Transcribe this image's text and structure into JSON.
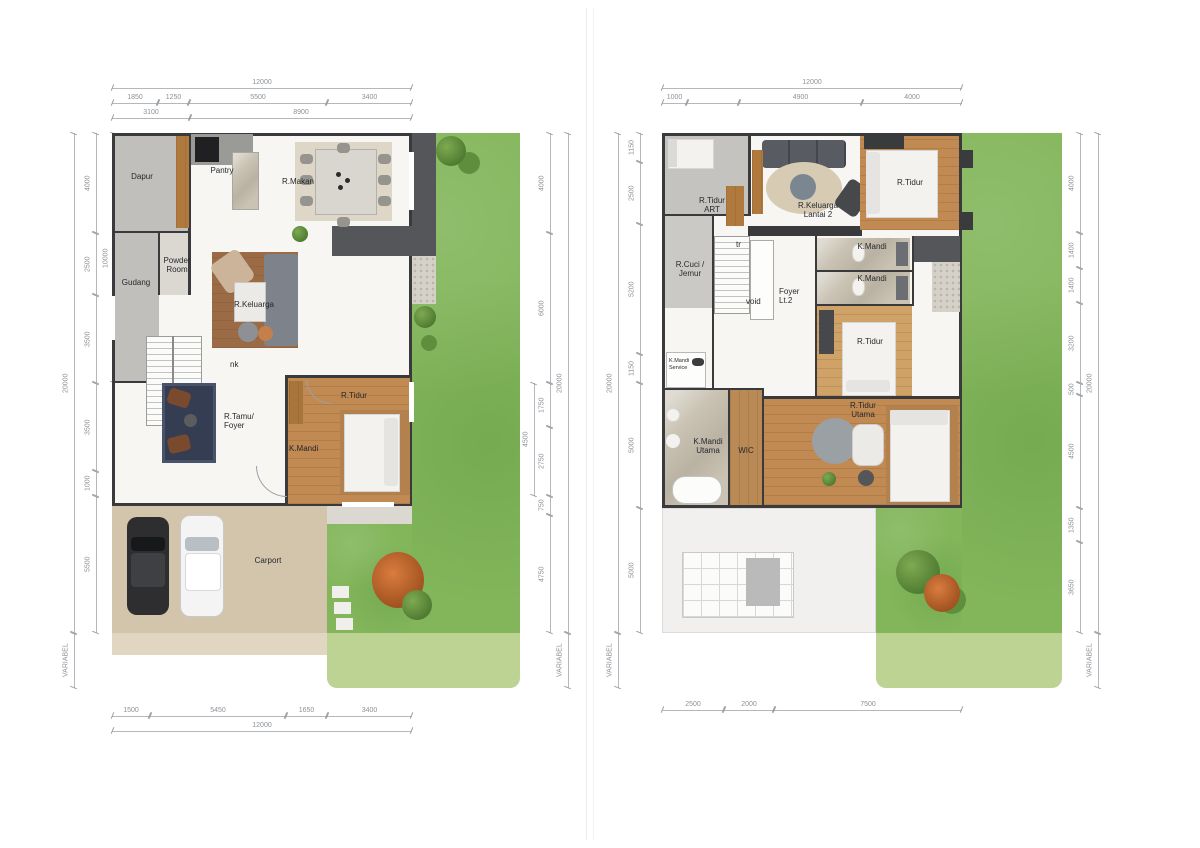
{
  "document": {
    "type": "architectural-floor-plan",
    "sheets": 2
  },
  "palette": {
    "wall": "#3a3a3c",
    "grass": "#83b65b",
    "grass_light": "#bdd394",
    "wood_floor": "#c18a52",
    "carport": "#d3c4ac",
    "dim_text": "#8d9296",
    "accent_shrub": "#c96a33"
  },
  "plans": [
    {
      "key": "lantai-1",
      "dims": {
        "top_total": "12000",
        "top_row1": [
          "1850",
          "1250",
          "5500",
          "3400"
        ],
        "top_row2": [
          "3100",
          "8900"
        ],
        "bottom_row": [
          "1500",
          "5450",
          "1650",
          "3400"
        ],
        "bottom_total": "12000",
        "left_segs": [
          "4000",
          "2500",
          "3500",
          "3500",
          "1000",
          "5500"
        ],
        "left_group": "10000",
        "left_total": "20000",
        "left_var": "VARIABEL",
        "right_segs": [
          "4000",
          "6000",
          "1750",
          "2750",
          "750",
          "4750"
        ],
        "right_group": "4500",
        "right_total": "20000",
        "right_var": "VARIABEL"
      },
      "rooms": {
        "dapur": "Dapur",
        "pantry": "Pantry",
        "r_makan": "R.Makan",
        "gudang": "Gudang",
        "powder_room": "Powder Room",
        "r_keluarga": "R.Keluarga",
        "stairs_note": "nk",
        "r_tamu": "R.Tamu/ Foyer",
        "k_mandi": "K.Mandi",
        "r_tidur": "R.Tidur",
        "carport": "Carport"
      }
    },
    {
      "key": "lantai-2",
      "dims": {
        "top_total": "12000",
        "top_row": [
          "1000",
          "",
          "4900",
          "4000"
        ],
        "bottom_row": [
          "2500",
          "2000",
          "7500"
        ],
        "left_segs": [
          "1150",
          "2500",
          "5200",
          "1150",
          "5000",
          "5000"
        ],
        "left_total": "20000",
        "left_var": "VARIABEL",
        "right_segs": [
          "4000",
          "1400",
          "1400",
          "3200",
          "500",
          "4500",
          "1350",
          "3650"
        ],
        "right_total": "20000",
        "right_var": "VARIABEL"
      },
      "rooms": {
        "r_tidur_art": "R.Tidur ART",
        "r_keluarga_lt2": "R.Keluarga Lantai 2",
        "r_tidur_depan": "R.Tidur",
        "stairs_note": "tr",
        "r_cuci": "R.Cuci / Jemur",
        "void": "void",
        "foyer_lt2": "Foyer Lt.2",
        "k_mandi_1": "K.Mandi",
        "k_mandi_2": "K.Mandi",
        "k_mandi_service": "K.Mandi Service",
        "k_mandi_utama": "K.Mandi Utama",
        "wic": "WIC",
        "r_tidur_tengah": "R.Tidur",
        "r_tidur_utama": "R.Tidur Utama"
      }
    }
  ]
}
